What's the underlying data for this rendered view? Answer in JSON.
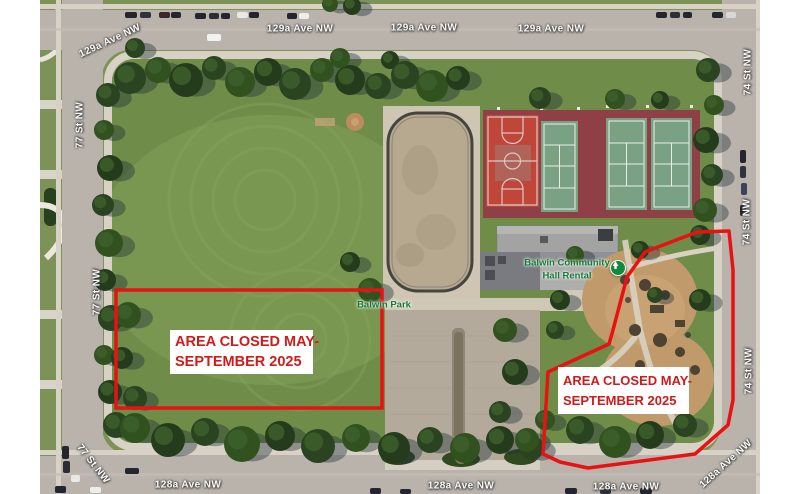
{
  "streets": {
    "ave_129a": "129a Ave NW",
    "ave_128a": "128a Ave NW",
    "st_77": "77 St NW",
    "st_74": "74 St NW"
  },
  "poi": {
    "hall_line1": "Balwin Community",
    "hall_line2": "Hall Rental",
    "park": "Balwin Park"
  },
  "closure": {
    "line1": "AREA CLOSED MAY-",
    "line2": "SEPTEMBER 2025"
  },
  "colors": {
    "closure_outline": "#e81212",
    "closure_text": "#d11a1a",
    "poi_green": "#157a38",
    "street_label_text": "#fbfaf7",
    "road": "#b9b3ac",
    "grass": "#6f8c49",
    "court_surround": "#8f4046",
    "basketball_red": "#c0463a",
    "tennis_green": "#7aa184",
    "rink_surface": "#b7a890",
    "playground_sand": "#c09a6b"
  }
}
